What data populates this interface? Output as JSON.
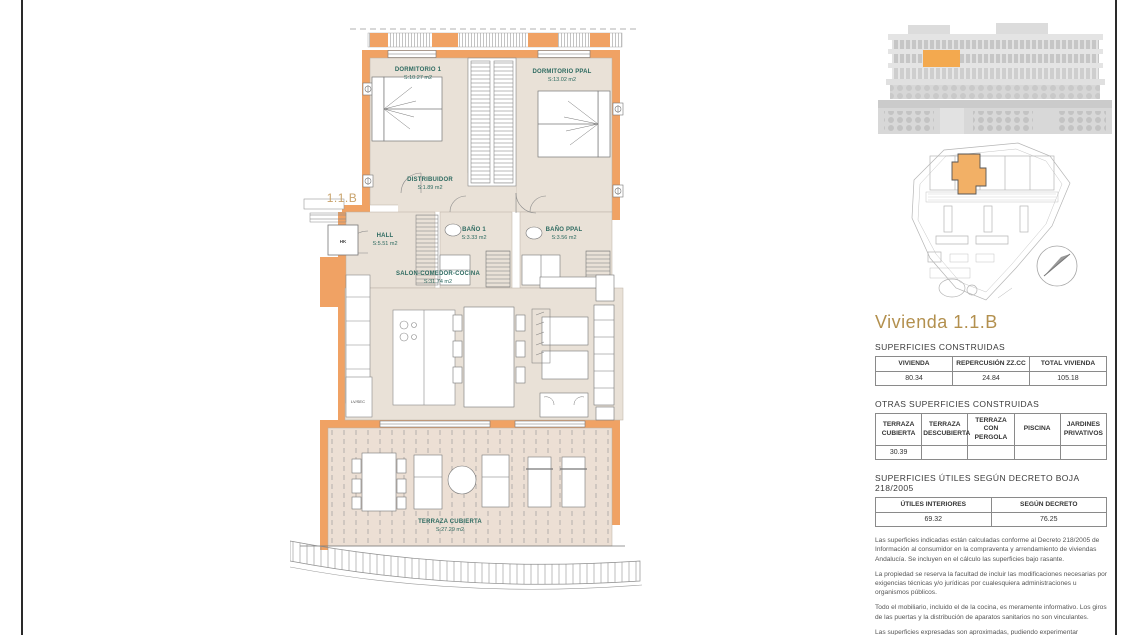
{
  "floor_plan": {
    "unit_label": "1.1.B",
    "rooms": [
      {
        "name": "DORMITORIO 1",
        "area": "S:10.27 m2"
      },
      {
        "name": "DORMITORIO PPAL",
        "area": "S:13.02 m2"
      },
      {
        "name": "DISTRIBUIDOR",
        "area": "S:1.89 m2"
      },
      {
        "name": "HALL",
        "area": "S:5.51 m2"
      },
      {
        "name": "BAÑO 1",
        "area": "S:3.33 m2"
      },
      {
        "name": "BAÑO PPAL",
        "area": "S:3.56 m2"
      },
      {
        "name": "SALON-COMEDOR-COCINA",
        "area": "S:31.74 m2"
      },
      {
        "name": "TERRAZA CUBIERTA",
        "area": "S:27.29 m2"
      }
    ],
    "annotations": {
      "hk": "HK",
      "lvsec": "LV/SEC"
    }
  },
  "info_panel": {
    "title": "Vivienda 1.1.B",
    "section1_title": "SUPERFICIES CONSTRUIDAS",
    "table1": {
      "headers": [
        "VIVIENDA",
        "REPERCUSIÓN ZZ.CC",
        "TOTAL VIVIENDA"
      ],
      "values": [
        "80.34",
        "24.84",
        "105.18"
      ]
    },
    "section2_title": "OTRAS SUPERFICIES CONSTRUIDAS",
    "table2": {
      "headers": [
        "TERRAZA CUBIERTA",
        "TERRAZA DESCUBIERTA",
        "TERRAZA CON PERGOLA",
        "PISCINA",
        "JARDINES PRIVATIVOS"
      ],
      "values": [
        "30.39",
        "",
        "",
        "",
        ""
      ]
    },
    "section3_title": "SUPERFICIES ÚTILES SEGÚN DECRETO BOJA 218/2005",
    "table3": {
      "headers": [
        "ÚTILES INTERIORES",
        "SEGÚN DECRETO"
      ],
      "values": [
        "69.32",
        "76.25"
      ]
    },
    "disclaimers": [
      "Las superficies indicadas están calculadas conforme al Decreto 218/2005 de Información al consumidor en la compraventa y arrendamiento de viviendas Andalucía. Se incluyen en el cálculo las superficies bajo rasante.",
      "La propiedad se reserva la facultad de incluir las modificaciones necesarias por exigencias técnicas y/o jurídicas por cualesquiera administraciones u organismos públicos.",
      "Todo el mobiliario, incluido el de la cocina, es meramente informativo. Los giros de las puertas y la distribución de aparatos sanitarios no son vinculantes.",
      "Las superficies expresadas son aproximadas, pudiendo experimentar modificaciones por razones de índole técnica en el desarrollo del proyecto de ejecución o durante el transcurso de las obras."
    ]
  },
  "colors": {
    "wall_orange": "#F0A264",
    "highlight_orange": "#F3A94F",
    "floor_beige": "#E9E1D7",
    "terrace_beige": "#ECDFD4",
    "label_teal": "#2d6a60",
    "title_tan": "#b3904e"
  }
}
